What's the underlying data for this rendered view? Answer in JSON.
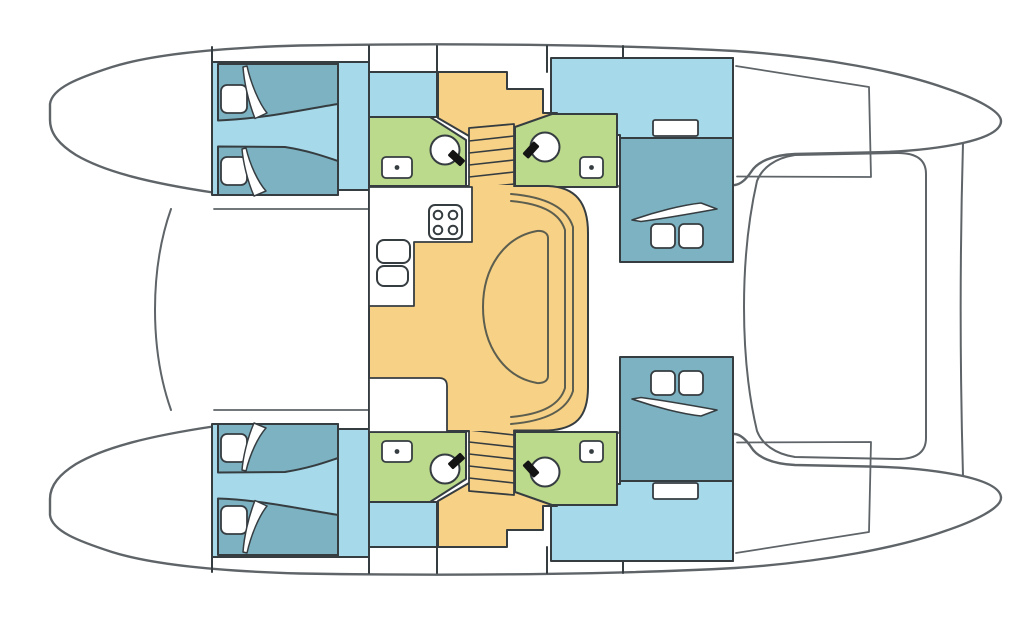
{
  "diagram": {
    "type": "catamaran-deck-plan",
    "orientation": {
      "bow": "left",
      "stern": "right",
      "symmetry": "port and starboard hulls mirrored about horizontal centerline"
    },
    "colors": {
      "white": "#ffffff",
      "outline": "#5e6468",
      "wall": "#363d41",
      "cabin_floor": "#a6d9e9",
      "berth": "#7cb2c1",
      "bathroom": "#bcda8c",
      "saloon": "#f7d186",
      "toilet_seat": "#141414",
      "furniture_line": "#5c5e4f"
    },
    "rooms": [
      {
        "id": "forward-cabin-top",
        "label": "Forward cabin, top hull: two single berths with pillows and turned-down blankets"
      },
      {
        "id": "forward-cabin-bottom",
        "label": "Forward cabin, bottom hull: two single berths with pillows and turned-down blankets"
      },
      {
        "id": "bathroom-forward-top",
        "label": "Forward head, top hull: toilet and washbasin"
      },
      {
        "id": "bathroom-aft-top",
        "label": "Aft head, top hull: toilet and washbasin"
      },
      {
        "id": "bathroom-forward-bottom",
        "label": "Forward head, bottom hull: toilet and washbasin"
      },
      {
        "id": "bathroom-aft-bottom",
        "label": "Aft head, bottom hull: toilet and washbasin"
      },
      {
        "id": "staircase-top",
        "label": "Companionway steps down into top hull"
      },
      {
        "id": "staircase-bottom",
        "label": "Companionway steps down into bottom hull"
      },
      {
        "id": "aft-cabin-top",
        "label": "Aft cabin, top hull: athwartships double berth with two pillows and shelf"
      },
      {
        "id": "aft-cabin-bottom",
        "label": "Aft cabin, bottom hull: athwartships double berth with two pillows and shelf"
      },
      {
        "id": "saloon",
        "label": "Bridgedeck saloon: galley with stove and double sink, chart table, D-shaped dinette table with wrap-around settee"
      },
      {
        "id": "cockpit",
        "label": "Aft cockpit with curved bench"
      },
      {
        "id": "foredeck",
        "label": "Foredeck / trampoline between bows"
      }
    ],
    "fixtures": {
      "stove_burners": 4,
      "galley_sinks": 2,
      "toilets": 4,
      "washbasins": 4,
      "single_berths": 4,
      "double_berths": 2,
      "pillows": 8
    }
  }
}
